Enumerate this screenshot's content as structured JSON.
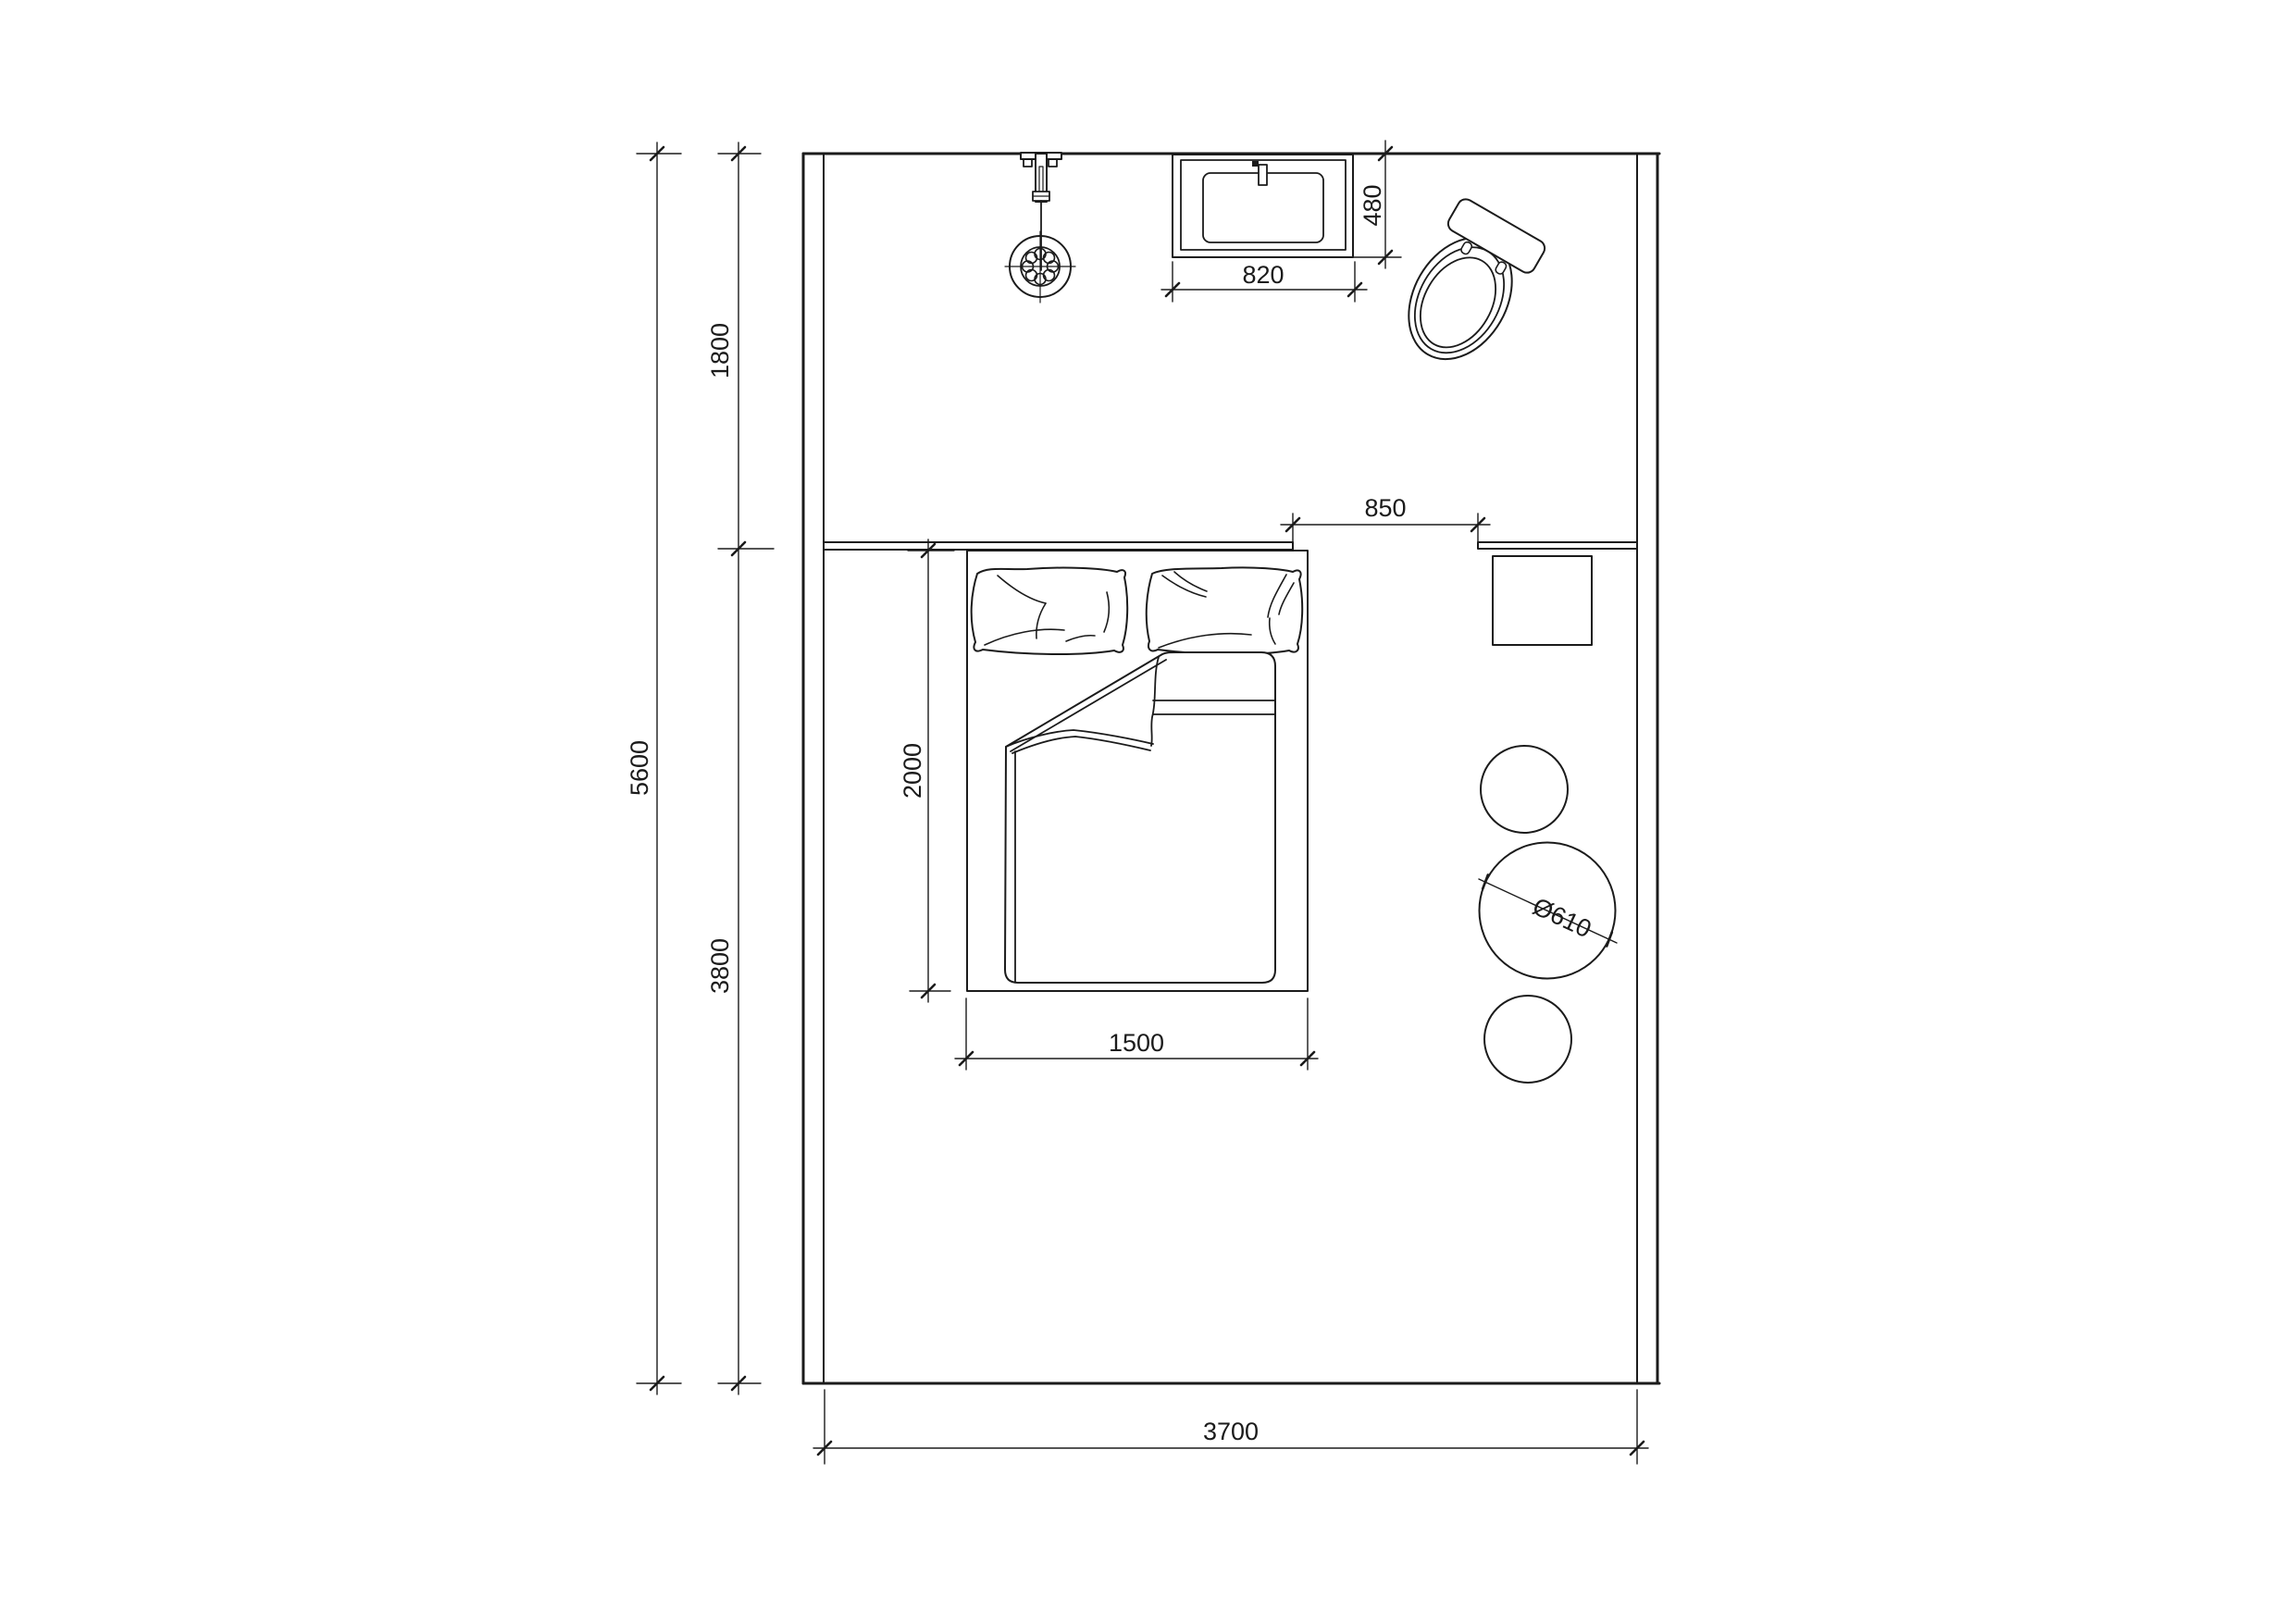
{
  "colors": {
    "line": "#1b1b1b",
    "background": "#ffffff"
  },
  "dims": {
    "room_height": "5600",
    "upper_zone": "1800",
    "lower_zone": "3800",
    "room_width": "3700",
    "bed_length": "2000",
    "bed_width": "1500",
    "bed_side_gap": "850",
    "vanity_width": "820",
    "vanity_depth": "480",
    "stool_diameter": "Ø610"
  },
  "fixtures": {
    "shower": "shower-head",
    "vanity": "vanity-basin",
    "toilet": "toilet",
    "bed": "double-bed",
    "ledge": "headboard-ledge",
    "shelf": "desk-shelf",
    "nightstand": "nightstand",
    "stool": "stool"
  }
}
